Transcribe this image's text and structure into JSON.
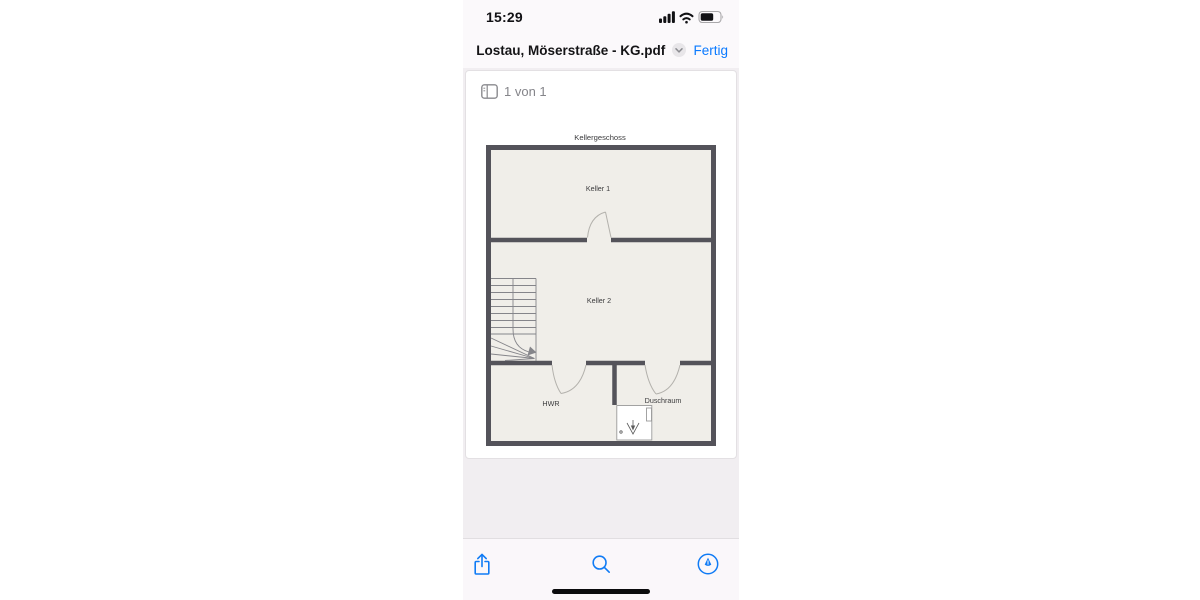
{
  "status_bar": {
    "time": "15:29",
    "icons": [
      "cellular-signal-icon",
      "wifi-icon",
      "battery-icon"
    ]
  },
  "nav_bar": {
    "title": "Lostau, Möserstraße - KG.pdf",
    "title_chevron_icon": "chevron-down-icon",
    "done_label": "Fertig"
  },
  "page_indicator": {
    "icon": "sidebar-thumbnails-icon",
    "label": "1 von 1"
  },
  "floor_plan": {
    "title": "Kellergeschoss",
    "rooms": [
      {
        "name": "Keller 1"
      },
      {
        "name": "Keller 2"
      },
      {
        "name": "HWR"
      },
      {
        "name": "Duschraum"
      }
    ],
    "features": [
      "staircase-with-winders",
      "door-swings",
      "shower-tray-with-drain"
    ]
  },
  "toolbar": {
    "icons": [
      "share-icon",
      "search-icon",
      "markup-pen-icon"
    ]
  },
  "colors": {
    "accent_blue": "#0a7aff",
    "wall": "#54535a",
    "plan_floor": "#f0eee9",
    "page_background": "#ffffff",
    "content_background": "#f1eef1",
    "muted_text": "#85858a"
  }
}
